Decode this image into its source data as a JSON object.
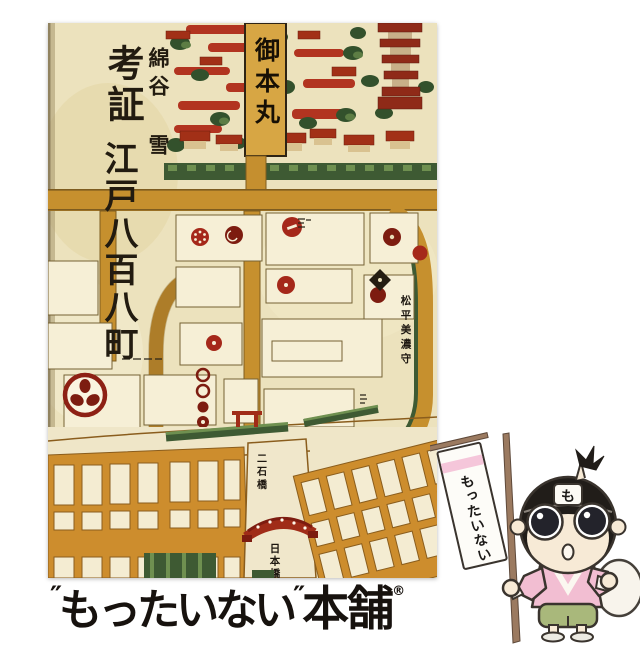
{
  "book": {
    "author": "綿谷 雪",
    "title_prefix": "考証",
    "title_main": "江戸八百八町",
    "map_labels": {
      "castle_keep": "御本丸",
      "daimyo_residence": "松平美濃守",
      "bridge_upper": "二石橋",
      "bridge_lower": "日本橋"
    }
  },
  "mascot": {
    "flag_text": "もったいない",
    "headband_text": "も"
  },
  "logo": {
    "open_quote": "″",
    "name": "もったいない",
    "close_quote": "″",
    "suffix": "本舗",
    "registered_mark": "®"
  },
  "colors": {
    "page_background": "#ffffff",
    "cover_paper": "#ece2bd",
    "map_block_cream": "#f6efd6",
    "map_road_tan": "#c6902e",
    "map_block_orange": "#cd8d2d",
    "map_roof_red": "#a23017",
    "map_cloud_red": "#b23420",
    "map_crest_red": "#7d1c10",
    "map_tree_green": "#33512c",
    "hedge_green": "#3e5a33",
    "ink_black": "#1c1712",
    "mascot_kimono_pink": "#f2bed2",
    "mascot_hakama_green": "#a9b87b",
    "mascot_skin": "#f7ead6",
    "flag_stripe_pink": "#f5c6da",
    "flag_pole_brown": "#9b7a60",
    "logo_black": "#17120e"
  }
}
